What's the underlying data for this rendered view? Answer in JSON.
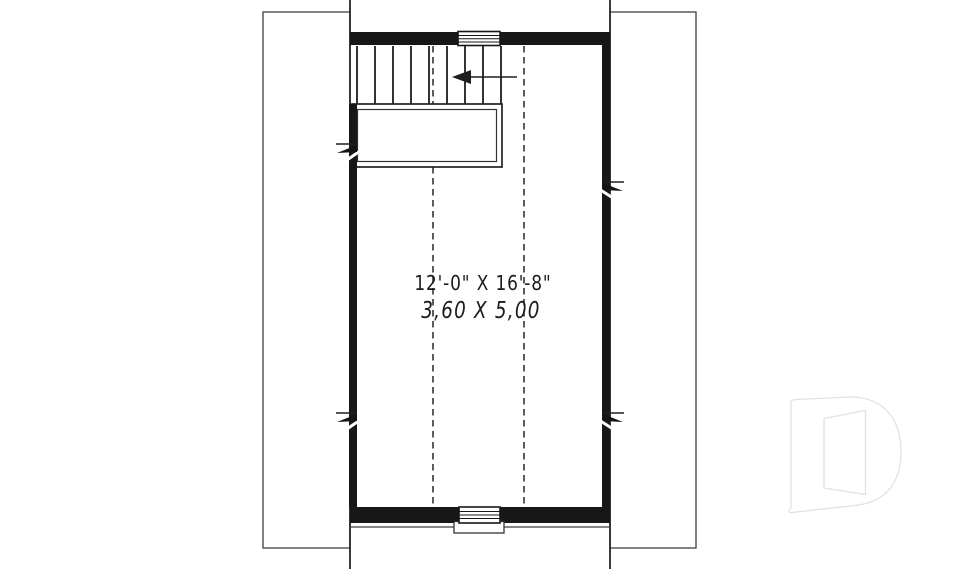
{
  "plan": {
    "type": "attic-bonus-room-floor-plan",
    "room": {
      "dimension_imperial": "12'-0\" X 16'-8\"",
      "dimension_metric": "3,60 X 5,00"
    },
    "stairs": {
      "tread_count": 9,
      "arrow_direction": "left"
    },
    "colors": {
      "wall": "#171717",
      "line": "#262626",
      "thin_line": "#3f3f3f",
      "text": "#1c1c1c",
      "watermark": "#e2e2e2",
      "background": "#ffffff"
    },
    "watermark": "drummond-d-logo"
  }
}
